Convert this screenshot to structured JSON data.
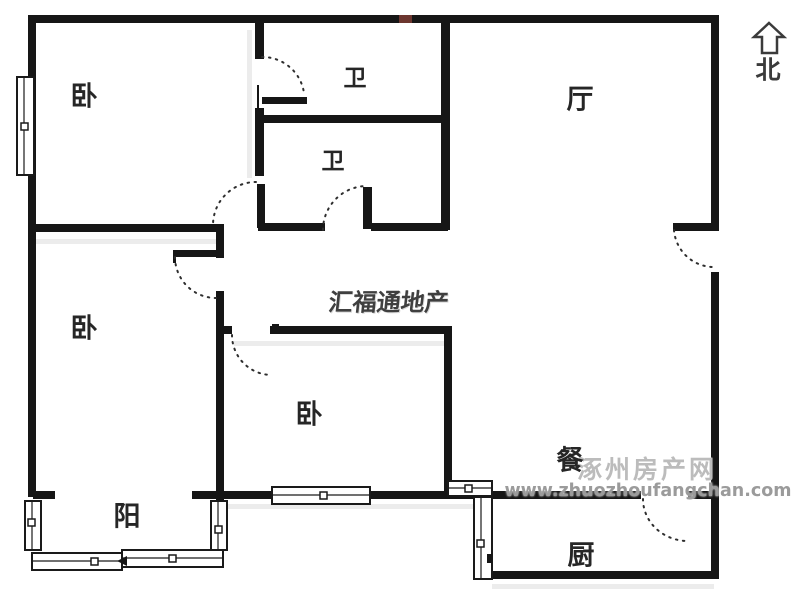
{
  "compass": {
    "label": "北"
  },
  "rooms": {
    "bedroom_main": {
      "label": "卧"
    },
    "bedroom_west": {
      "label": "卧"
    },
    "bedroom_middle": {
      "label": "卧"
    },
    "bath_ensuite": {
      "label": "卫"
    },
    "bath_common": {
      "label": "卫"
    },
    "hall": {
      "label": "厅"
    },
    "dining": {
      "label": "餐"
    },
    "kitchen": {
      "label": "厨"
    },
    "balcony": {
      "label": "阳"
    }
  },
  "watermarks": {
    "agency": "汇福通地产",
    "site_name": "涿州房产网",
    "site_url": "www.zhuozhoufangchan.com"
  },
  "colors": {
    "wall": "#161616",
    "door_arc": "#2e2e2e",
    "watermark_agency": "#3f3f3f",
    "watermark_site": "#bcbcbc",
    "watermark_url": "#9b9b9b",
    "entry_marker": "#8a4138",
    "background": "#ffffff"
  }
}
